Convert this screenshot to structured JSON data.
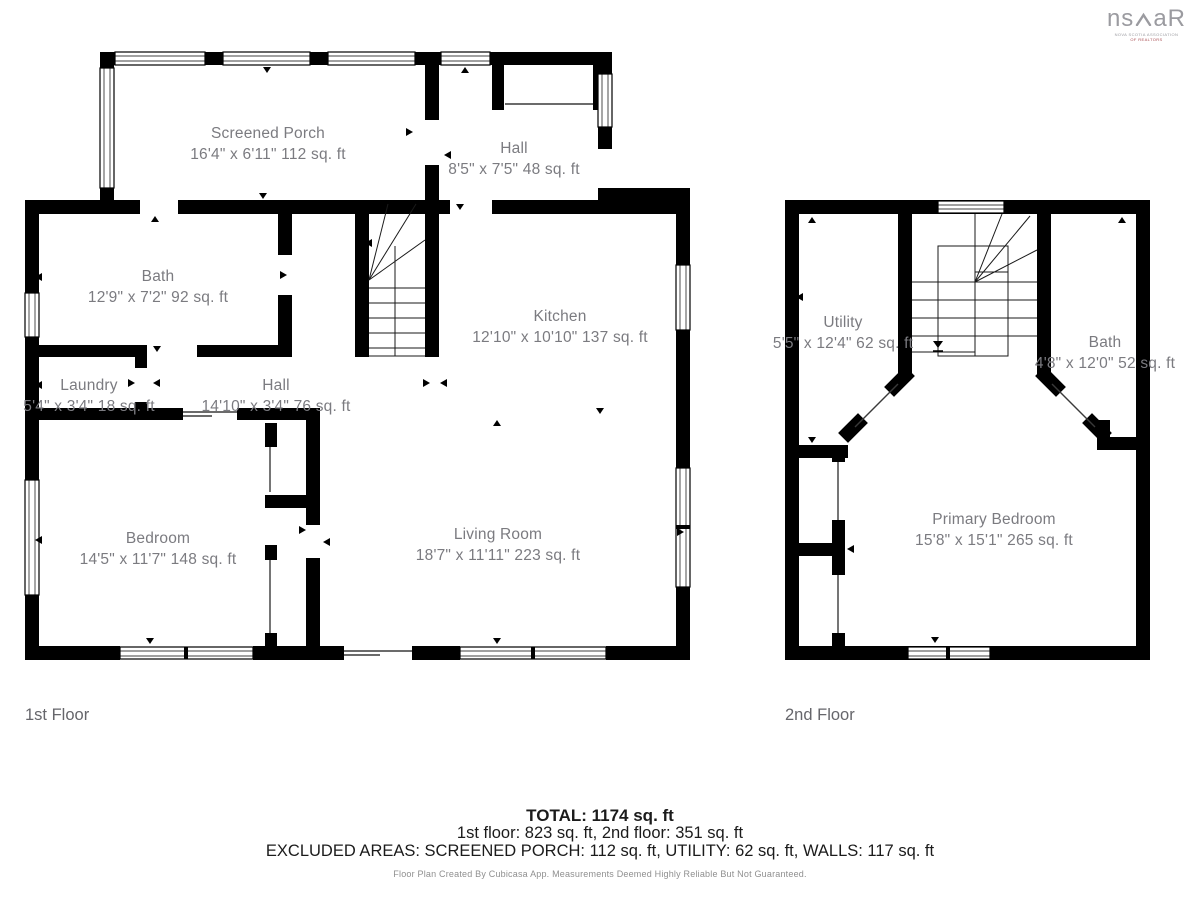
{
  "logo": {
    "left": "ns",
    "right": "aR",
    "subline1": "NOVA SCOTIA ASSOCIATION",
    "subline2": "OF REALTORS"
  },
  "floors": [
    {
      "label": "1st Floor",
      "rooms": [
        {
          "name": "Screened Porch",
          "dims": "16'4\" x 6'11\" 112 sq. ft"
        },
        {
          "name": "Hall",
          "dims": "8'5\" x 7'5\" 48 sq. ft"
        },
        {
          "name": "Bath",
          "dims": "12'9\" x 7'2\" 92 sq. ft"
        },
        {
          "name": "Kitchen",
          "dims": "12'10\" x 10'10\" 137 sq. ft"
        },
        {
          "name": "Laundry",
          "dims": "5'4\" x 3'4\" 18 sq. ft"
        },
        {
          "name": "Hall",
          "dims": "14'10\" x 3'4\" 76 sq. ft"
        },
        {
          "name": "Bedroom",
          "dims": "14'5\" x 11'7\" 148 sq. ft"
        },
        {
          "name": "Living Room",
          "dims": "18'7\" x 11'11\" 223 sq. ft"
        }
      ]
    },
    {
      "label": "2nd Floor",
      "rooms": [
        {
          "name": "Utility",
          "dims": "5'5\" x 12'4\" 62 sq. ft"
        },
        {
          "name": "Bath",
          "dims": "4'8\" x 12'0\" 52 sq. ft"
        },
        {
          "name": "Primary Bedroom",
          "dims": "15'8\" x 15'1\" 265 sq. ft"
        }
      ]
    }
  ],
  "summary": {
    "total": "TOTAL: 1174 sq. ft",
    "floors_line": "1st floor: 823 sq. ft, 2nd floor: 351 sq. ft",
    "excluded_line": "EXCLUDED AREAS: SCREENED PORCH: 112 sq. ft, UTILITY: 62 sq. ft, WALLS: 117 sq. ft",
    "disclaimer": "Floor Plan Created By Cubicasa App. Measurements Deemed Highly Reliable But Not Guaranteed."
  },
  "colors": {
    "wall": "#000000",
    "room_text": "#7b7b80",
    "floor_label_text": "#66666b",
    "logo_gray": "#9b9ba0",
    "logo_red": "#a84b50"
  }
}
